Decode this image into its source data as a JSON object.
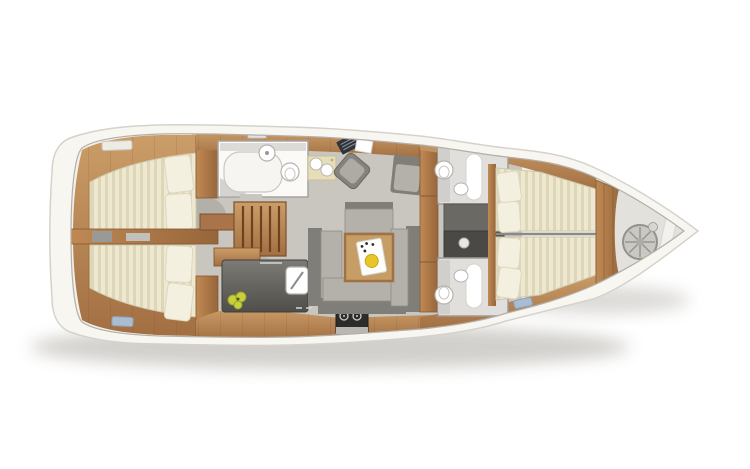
{
  "title": "Sailing yacht interior layout floor plan (top view)",
  "palette": {
    "background": "#ffffff",
    "hull": "#f8f6f1",
    "hull_stroke": "#d6d2cb",
    "deck": "#f1efea",
    "floor": "#c9c6c0",
    "wood": "#b9834f",
    "mattress": "#efe8d1",
    "mattress_stripe": "#ded6b8",
    "pillow": "#f4f0df",
    "sofa_light": "#b4b1aa",
    "sofa_dark": "#807e78",
    "counter": "#6e6c66",
    "fixture": "#ffffff",
    "tray": "#fdfdfc",
    "head_aft": "#fbfaf7",
    "head_floor": "#e0dfdb",
    "engine_light": "#6b6964",
    "engine_dark": "#4a4945",
    "bow_floor": "#e3e1dc",
    "wheel": "#cac8c2",
    "fruit": "#c8d13b",
    "lemon": "#e9c528",
    "hatch_blue": "#a9bcd2",
    "hatch_white": "#ecebe4",
    "table_wood": "#c79d66"
  },
  "vessel": {
    "type": "monohull sailing yacht, below-deck layout",
    "bow": "right (tapered tip)",
    "stern": "left (rounded transom)",
    "rooms": [
      {
        "id": "aft-cabin-upper",
        "label": "double berth cabin (upper left)",
        "furniture": [
          "striped double mattress",
          "two pillows"
        ]
      },
      {
        "id": "aft-cabin-lower",
        "label": "double berth cabin (lower left)",
        "furniture": [
          "striped double mattress",
          "two pillows"
        ]
      },
      {
        "id": "head-aft",
        "label": "bathroom with shower (top center-left)",
        "furniture": [
          "shower tray",
          "washbasin",
          "toilet"
        ]
      },
      {
        "id": "companionway",
        "label": "wooden companionway stairs (center)"
      },
      {
        "id": "galley",
        "label": "galley (bottom center)",
        "furniture": [
          "dark worktop",
          "sink with faucet",
          "stove with two burners",
          "fruit"
        ]
      },
      {
        "id": "nav-station",
        "label": "navigation station (top center)",
        "furniture": [
          "chart table items",
          "swivel chair",
          "basin pad"
        ]
      },
      {
        "id": "salon",
        "label": "salon (center)",
        "furniture": [
          "U-shaped gray sofa",
          "armchair",
          "square wooden table",
          "white tray with lemon"
        ]
      },
      {
        "id": "head-forward-upper",
        "label": "bathroom (upper right)",
        "furniture": [
          "toilet",
          "washbasin",
          "shower panel"
        ]
      },
      {
        "id": "head-forward-lower",
        "label": "bathroom (lower right)",
        "furniture": [
          "toilet",
          "washbasin",
          "shower panel"
        ]
      },
      {
        "id": "engine-compartment",
        "label": "technical compartment between right bathrooms"
      },
      {
        "id": "forward-cabin",
        "label": "V-berth cabin (right)",
        "furniture": [
          "two striped tapering mattresses",
          "four pillows"
        ]
      },
      {
        "id": "bow-compartment",
        "label": "bow tip compartment",
        "furniture": [
          "spoked wheel / coiled line"
        ]
      }
    ]
  }
}
